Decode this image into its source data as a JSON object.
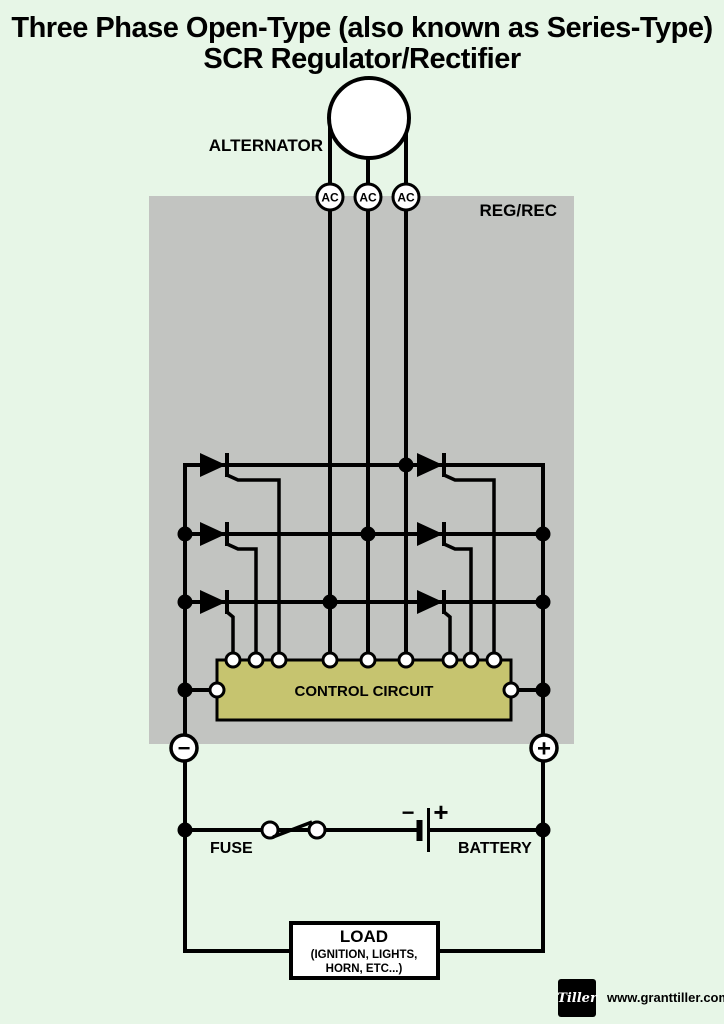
{
  "title": {
    "line1": "Three Phase Open-Type (also known as Series-Type)",
    "line2": "SCR Regulator/Rectifier"
  },
  "alternator": {
    "label": "ALTERNATOR",
    "ac_labels": [
      "AC",
      "AC",
      "AC"
    ]
  },
  "regrec": {
    "label": "REG/REC"
  },
  "control": {
    "label": "CONTROL CIRCUIT"
  },
  "terminals": {
    "negative": "−",
    "positive": "+"
  },
  "fuse": {
    "label": "FUSE"
  },
  "battery": {
    "label": "BATTERY",
    "minus": "−",
    "plus": "+"
  },
  "load": {
    "line1": "LOAD",
    "line2": "(IGNITION, LIGHTS,",
    "line3": "HORN, ETC...)"
  },
  "footer": {
    "logo": "Tiller",
    "website": "www.granttiller.com"
  },
  "colors": {
    "background": "#e7f6e7",
    "regrec_bg": "#c2c4c1",
    "control_bg": "#c6c46f",
    "red": "#ee1111",
    "wire": "#000000"
  }
}
